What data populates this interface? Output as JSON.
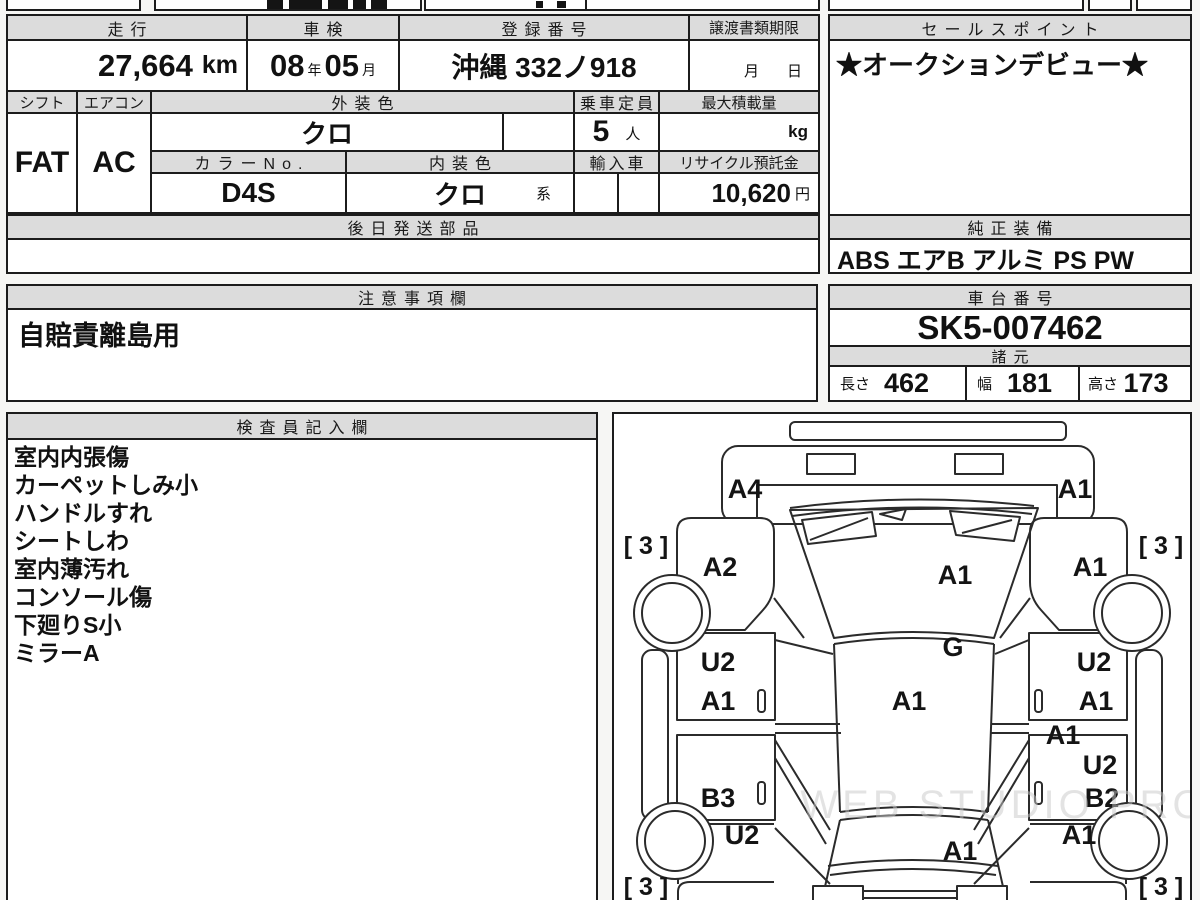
{
  "header_row": {
    "mileage": {
      "label": "走行",
      "value": "27,664",
      "unit": "km"
    },
    "inspection": {
      "label": "車検",
      "year": "08",
      "year_suffix": "年",
      "month": "05",
      "month_suffix": "月"
    },
    "registration": {
      "label": "登録番号",
      "value": "沖縄 332ノ918"
    },
    "transfer_deadline": {
      "label": "譲渡書類期限",
      "month_suffix": "月",
      "day_suffix": "日"
    },
    "sales_point": {
      "label": "セールスポイント",
      "value": "★オークションデビュー★"
    }
  },
  "spec_row": {
    "shift": {
      "label": "シフト",
      "value": "FAT"
    },
    "aircon": {
      "label": "エアコン",
      "value": "AC"
    },
    "exterior_color": {
      "label": "外装色",
      "value": "クロ"
    },
    "capacity": {
      "label": "乗車定員",
      "value": "5",
      "unit": "人"
    },
    "max_load": {
      "label": "最大積載量",
      "unit": "kg"
    },
    "color_no": {
      "label": "カラーNo.",
      "value": "D4S"
    },
    "interior_color": {
      "label": "内装色",
      "value": "クロ",
      "suffix": "系"
    },
    "imported": {
      "label": "輸入車"
    },
    "recycle_deposit": {
      "label": "リサイクル預託金",
      "value": "10,620",
      "unit": "円"
    }
  },
  "later_shipping_parts": {
    "label": "後日発送部品",
    "value": ""
  },
  "genuine_equipment": {
    "label": "純正装備",
    "value": "ABS エアB アルミ PS PW"
  },
  "notes": {
    "label": "注意事項欄",
    "value": "自賠責離島用"
  },
  "chassis_number": {
    "label": "車台番号",
    "value": "SK5-007462"
  },
  "dimensions": {
    "label": "諸元",
    "length_label": "長さ",
    "length": "462",
    "width_label": "幅",
    "width": "181",
    "height_label": "高さ",
    "height": "173"
  },
  "inspector_notes": {
    "label": "検査員記入欄",
    "items": [
      "室内内張傷",
      "カーペットしみ小",
      "ハンドルすれ",
      "シートしわ",
      "室内薄汚れ",
      "コンソール傷",
      "下廻りS小",
      "ミラーA"
    ]
  },
  "car_diagram": {
    "watermark": "WEB STUDIO PRO",
    "tire_grade_front_left": "[ 3 ]",
    "tire_grade_front_right": "[ 3 ]",
    "tire_grade_rear_left": "[ 3 ]",
    "tire_grade_rear_right": "[ 3 ]",
    "damage_labels": {
      "front_bumper_left": "A4",
      "front_bumper_right": "A1",
      "front_fender_left": "A2",
      "front_fender_right": "A1",
      "hood": "A1",
      "cowl": "G",
      "roof": "A1",
      "front_door_left_upper": "U2",
      "front_door_left_lower": "A1",
      "front_door_right_upper": "U2",
      "front_door_right_lower": "A1",
      "right_center_pillar": "A1",
      "rear_door_left": "B3",
      "rear_door_right_upper": "U2",
      "rear_door_right_lower": "B2",
      "rear_fender_left": "U2",
      "rear_fender_right": "A1",
      "rear_gate": "A1"
    }
  }
}
